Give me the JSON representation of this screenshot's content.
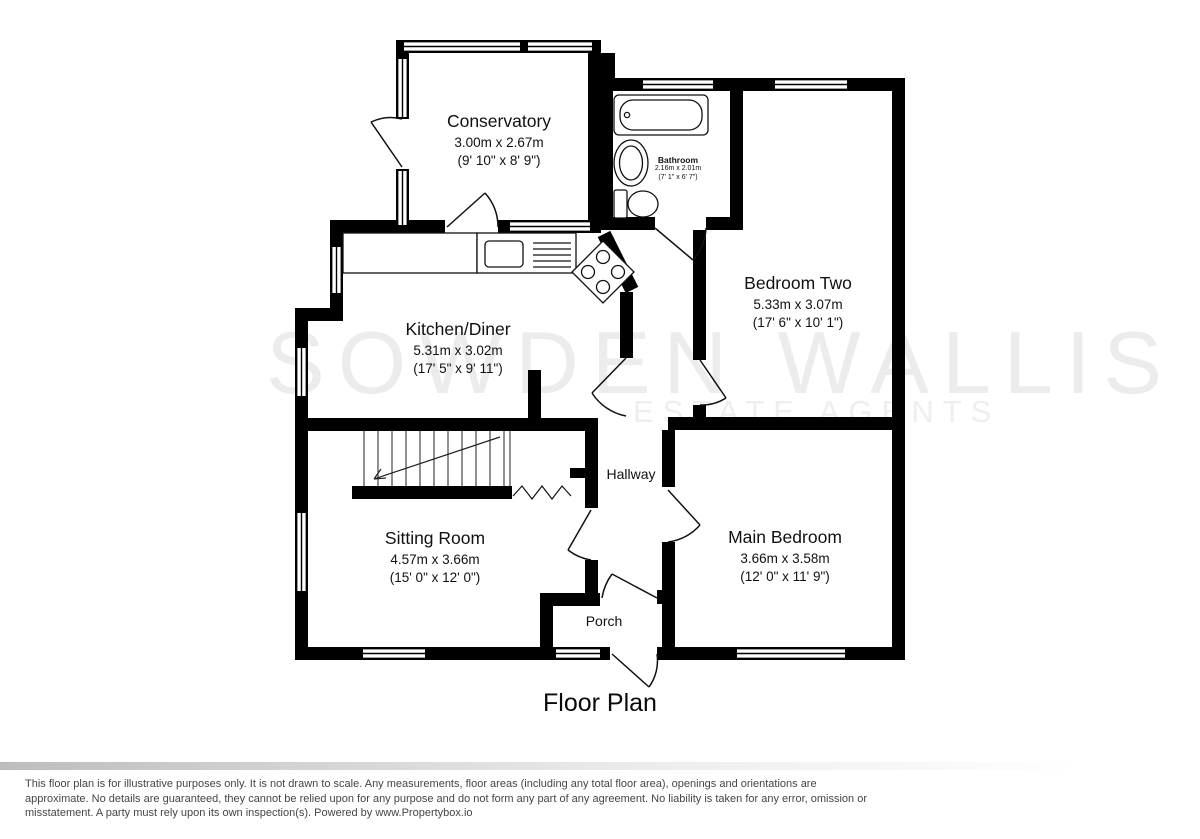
{
  "title": "Floor Plan",
  "watermark": {
    "line1": "SOWDEN WALLIS",
    "line2": "ESTATE AGENTS"
  },
  "rooms": {
    "conservatory": {
      "name": "Conservatory",
      "metric": "3.00m x 2.67m",
      "imperial": "(9' 10\" x 8' 9\")"
    },
    "bathroom": {
      "name": "Bathroom",
      "metric": "2.16m x 2.01m",
      "imperial": "(7' 1\" x 6' 7\")"
    },
    "bedroom_two": {
      "name": "Bedroom Two",
      "metric": "5.33m x 3.07m",
      "imperial": "(17' 6\" x 10' 1\")"
    },
    "kitchen_diner": {
      "name": "Kitchen/Diner",
      "metric": "5.31m x 3.02m",
      "imperial": "(17' 5\" x 9' 11\")"
    },
    "hallway": {
      "name": "Hallway"
    },
    "sitting_room": {
      "name": "Sitting Room",
      "metric": "4.57m x 3.66m",
      "imperial": "(15' 0\" x 12' 0\")"
    },
    "main_bedroom": {
      "name": "Main Bedroom",
      "metric": "3.66m x 3.58m",
      "imperial": "(12' 0\" x 11' 9\")"
    },
    "porch": {
      "name": "Porch"
    }
  },
  "disclaimer": {
    "line1": "This floor plan is for illustrative purposes only. It is not drawn to scale. Any measurements, floor areas (including any total floor area), openings and orientations are",
    "line2": "approximate. No details are guaranteed, they cannot be relied upon for any purpose and do not form any part of any agreement. No liability is taken for any error, omission or",
    "line3": "misstatement. A party must rely upon its own inspection(s). Powered by www.Propertybox.io"
  },
  "colors": {
    "wall": "#000000",
    "watermark": "#ececec",
    "disclaimer_text": "#454545"
  }
}
